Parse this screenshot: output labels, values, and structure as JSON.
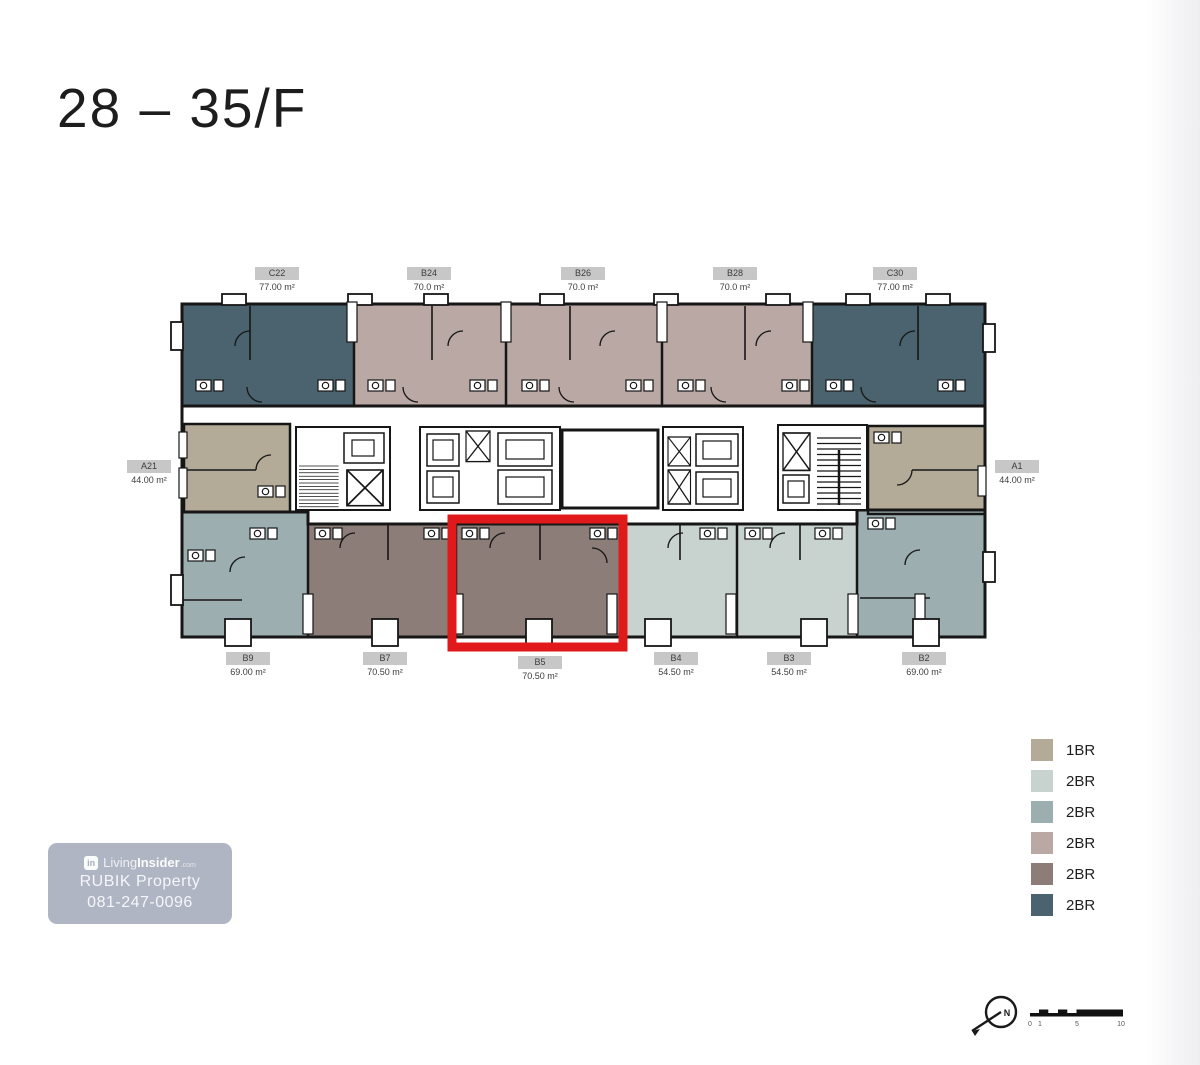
{
  "title": "28 – 35/F",
  "colors": {
    "beige": "#b3ab97",
    "light": "#c8d2cf",
    "grayblue": "#9caeb0",
    "mauve": "#b9a8a3",
    "brown": "#8c7d78",
    "slate": "#4b636e",
    "wall": "#161616",
    "highlight": "#e01a1a",
    "chip": "#c7c7c7"
  },
  "floorplan": {
    "highlighted_unit": "B5",
    "units": [
      {
        "id": "C22",
        "area": "77.00 m²",
        "type": "2BR",
        "color": "slate"
      },
      {
        "id": "B24",
        "area": "70.0 m²",
        "type": "2BR",
        "color": "mauve"
      },
      {
        "id": "B26",
        "area": "70.0 m²",
        "type": "2BR",
        "color": "mauve"
      },
      {
        "id": "B28",
        "area": "70.0 m²",
        "type": "2BR",
        "color": "mauve"
      },
      {
        "id": "C30",
        "area": "77.00 m²",
        "type": "2BR",
        "color": "slate"
      },
      {
        "id": "A21",
        "area": "44.00 m²",
        "type": "1BR",
        "color": "beige"
      },
      {
        "id": "A1",
        "area": "44.00 m²",
        "type": "1BR",
        "color": "beige"
      },
      {
        "id": "B9",
        "area": "69.00 m²",
        "type": "2BR",
        "color": "grayblue"
      },
      {
        "id": "B7",
        "area": "70.50 m²",
        "type": "2BR",
        "color": "brown"
      },
      {
        "id": "B5",
        "area": "70.50 m²",
        "type": "2BR",
        "color": "brown"
      },
      {
        "id": "B4",
        "area": "54.50 m²",
        "type": "2BR",
        "color": "light"
      },
      {
        "id": "B3",
        "area": "54.50 m²",
        "type": "2BR",
        "color": "light"
      },
      {
        "id": "B2",
        "area": "69.00 m²",
        "type": "2BR",
        "color": "grayblue"
      }
    ]
  },
  "legend": [
    {
      "label": "1BR",
      "color": "beige"
    },
    {
      "label": "2BR",
      "color": "light"
    },
    {
      "label": "2BR",
      "color": "grayblue"
    },
    {
      "label": "2BR",
      "color": "mauve"
    },
    {
      "label": "2BR",
      "color": "brown"
    },
    {
      "label": "2BR",
      "color": "slate"
    }
  ],
  "watermark": {
    "logo_text": "in",
    "brand_living": "Living",
    "brand_insider": "Insider",
    "brand_tld": ".com",
    "line2": "RUBIK Property",
    "line3": "081-247-0096"
  },
  "compass": {
    "north_label": "N"
  },
  "scalebar": {
    "ticks": [
      "0",
      "1",
      "5",
      "10"
    ]
  }
}
